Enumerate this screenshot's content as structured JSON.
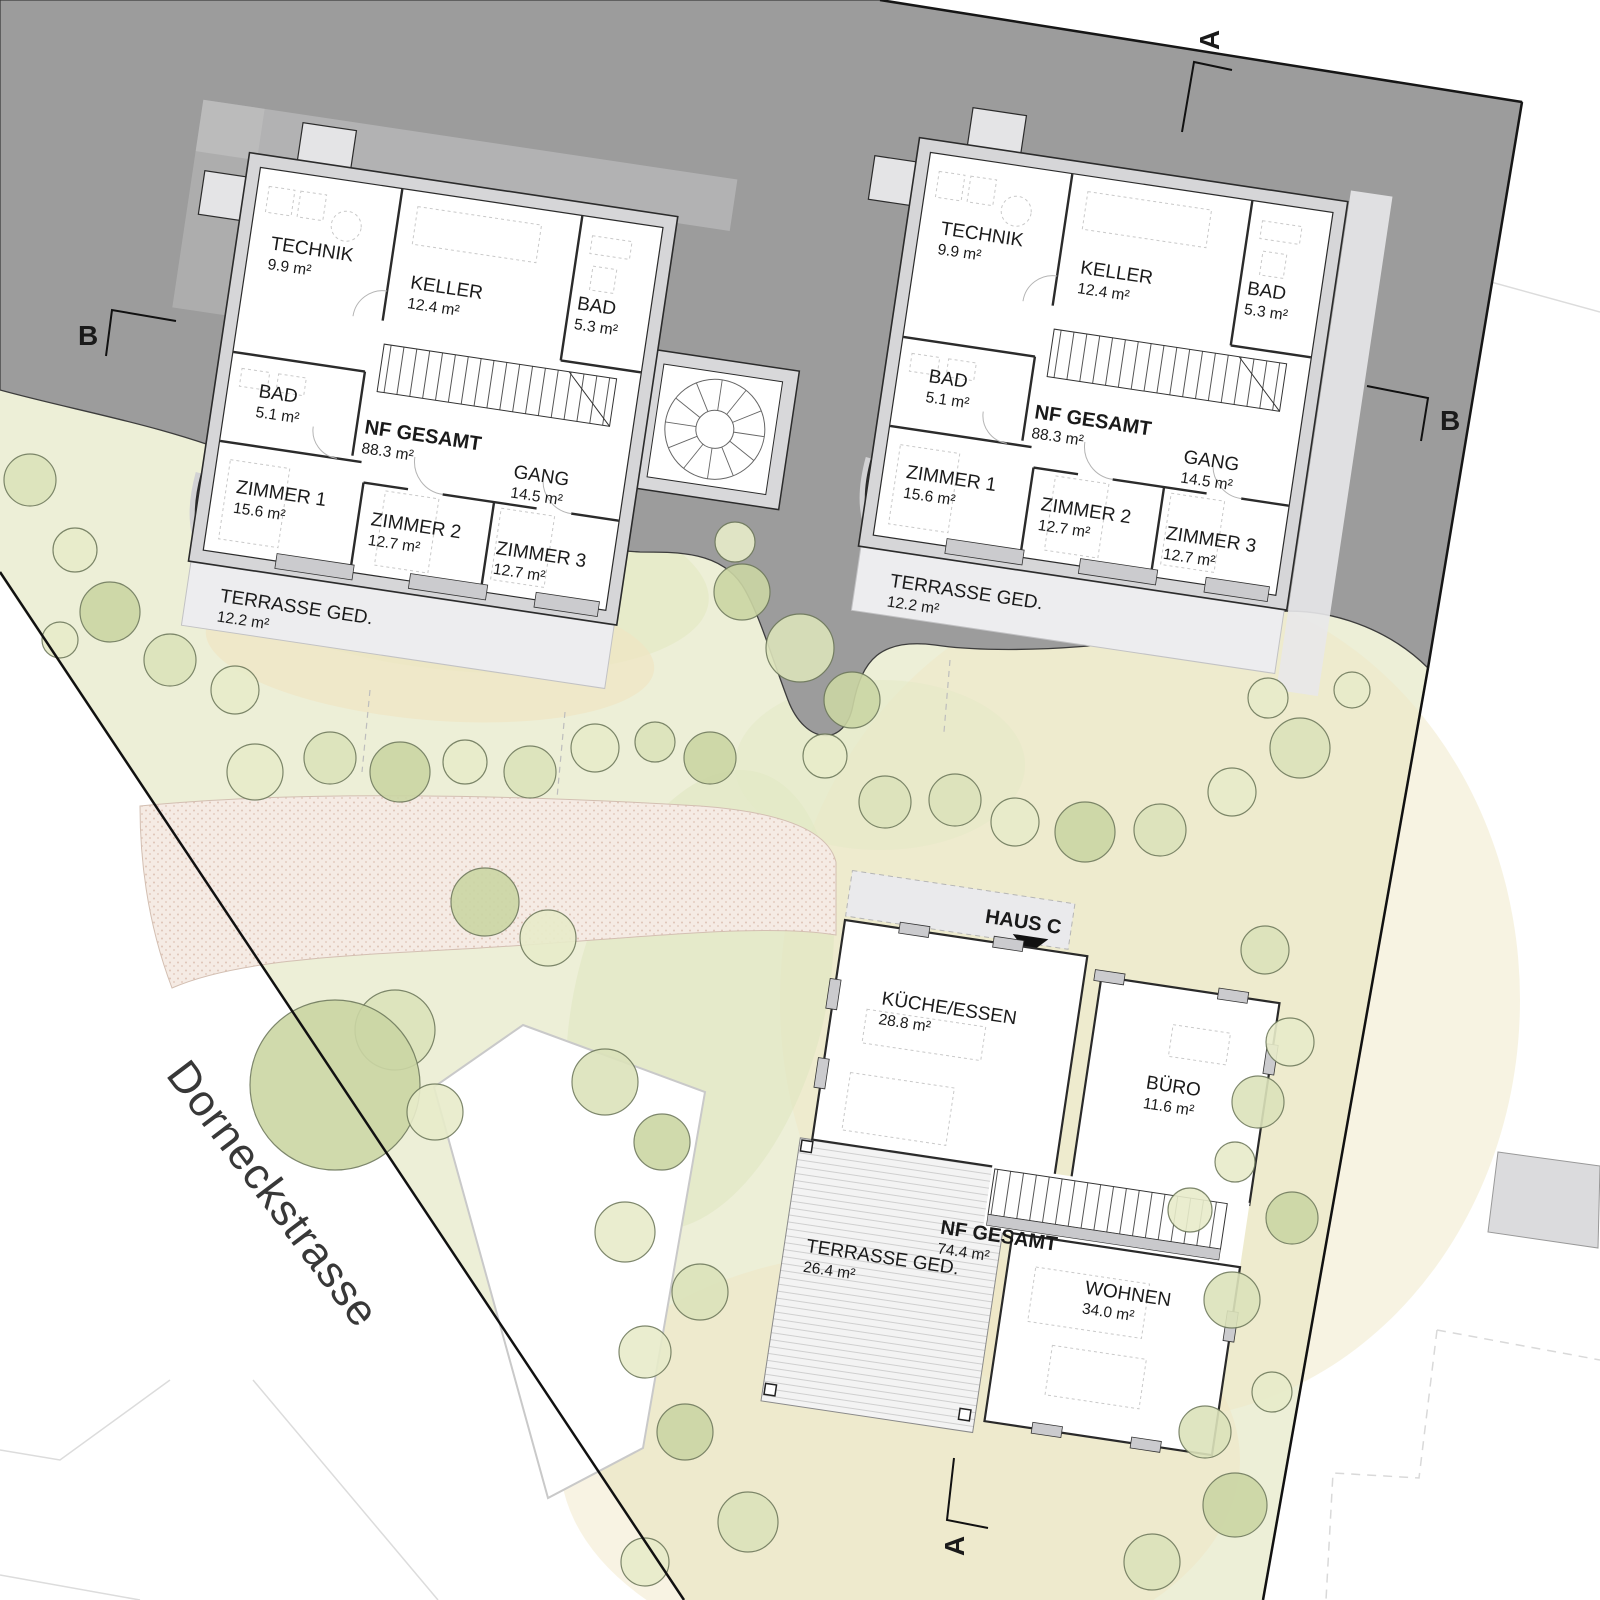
{
  "site": {
    "street_label": "Dorneckstrasse",
    "markers": {
      "a": "A",
      "b": "B"
    }
  },
  "houses": [
    {
      "id": "haus-a",
      "rooms": [
        {
          "name": "TECHNIK",
          "area": "9.9 m²"
        },
        {
          "name": "KELLER",
          "area": "12.4 m²"
        },
        {
          "name": "BAD",
          "area": "5.3 m²"
        },
        {
          "name": "BAD",
          "area": "5.1 m²"
        },
        {
          "name": "NF GESAMT",
          "area": "88.3 m²"
        },
        {
          "name": "GANG",
          "area": "14.5 m²"
        },
        {
          "name": "ZIMMER 1",
          "area": "15.6 m²"
        },
        {
          "name": "ZIMMER 2",
          "area": "12.7 m²"
        },
        {
          "name": "ZIMMER 3",
          "area": "12.7 m²"
        },
        {
          "name": "TERRASSE GED.",
          "area": "12.2 m²"
        }
      ]
    },
    {
      "id": "haus-b",
      "rooms": [
        {
          "name": "TECHNIK",
          "area": "9.9 m²"
        },
        {
          "name": "KELLER",
          "area": "12.4 m²"
        },
        {
          "name": "BAD",
          "area": "5.3 m²"
        },
        {
          "name": "BAD",
          "area": "5.1 m²"
        },
        {
          "name": "NF GESAMT",
          "area": "88.3 m²"
        },
        {
          "name": "GANG",
          "area": "14.5 m²"
        },
        {
          "name": "ZIMMER 1",
          "area": "15.6 m²"
        },
        {
          "name": "ZIMMER 2",
          "area": "12.7 m²"
        },
        {
          "name": "ZIMMER 3",
          "area": "12.7 m²"
        },
        {
          "name": "TERRASSE GED.",
          "area": "12.2 m²"
        }
      ]
    },
    {
      "id": "haus-c",
      "label": "HAUS C",
      "rooms": [
        {
          "name": "KÜCHE/ESSEN",
          "area": "28.8 m²"
        },
        {
          "name": "BÜRO",
          "area": "11.6 m²"
        },
        {
          "name": "NF GESAMT",
          "area": "74.4 m²"
        },
        {
          "name": "WOHNEN",
          "area": "34.0 m²"
        },
        {
          "name": "TERRASSE GED.",
          "area": "26.4 m²"
        }
      ]
    }
  ],
  "colors": {
    "road": "#9c9c9c",
    "garden": "#edefd7",
    "path": "#f5ebe4",
    "wall": "#d6d6d8",
    "terrace": "#ededef"
  }
}
